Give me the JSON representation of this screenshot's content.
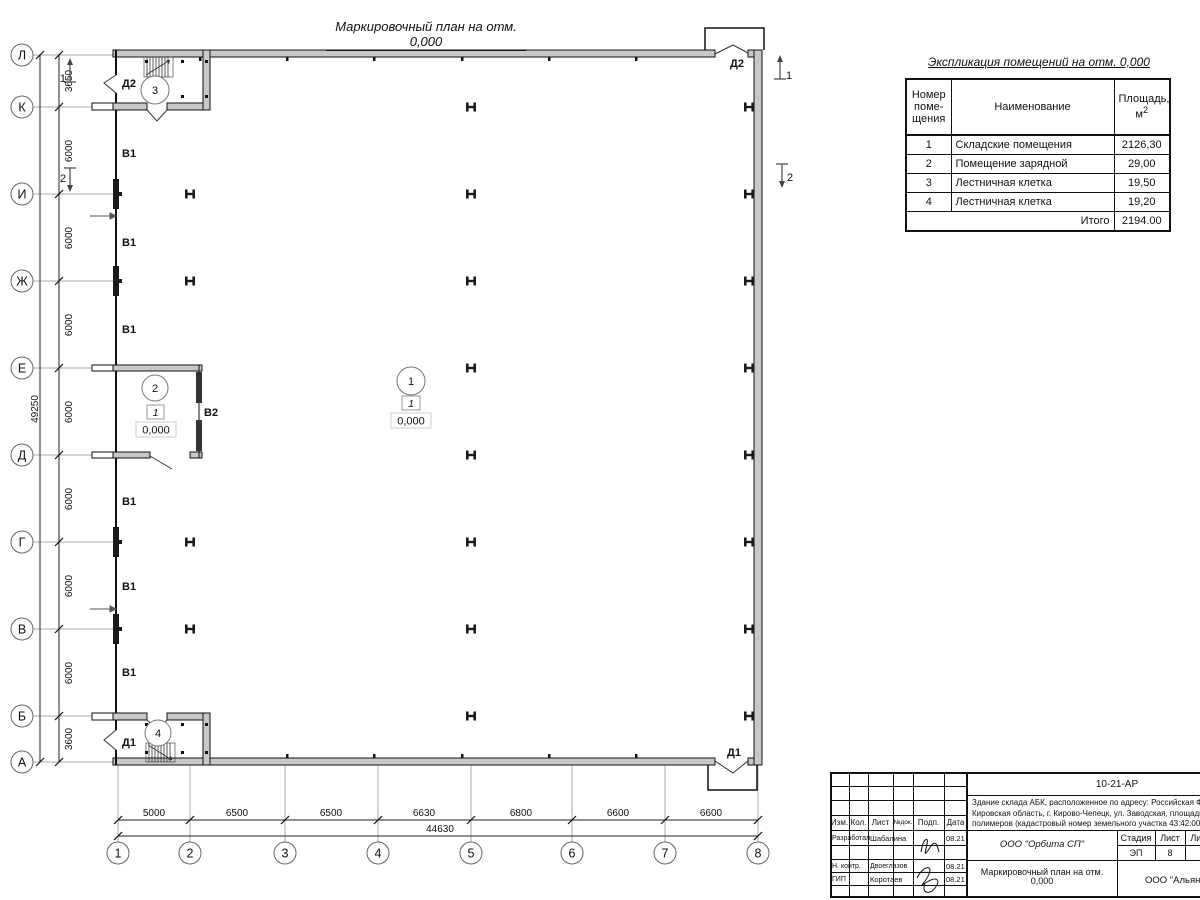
{
  "colors": {
    "line": "#1a1a1a",
    "grid": "#a0a0a0",
    "wall_fill": "#c8c8c8",
    "paper": "#ffffff"
  },
  "drawing_title": "Маркировочный план на отм. 0,000",
  "schedule": {
    "title": "Экспликация помещений на отм. 0,000",
    "col_number": "Номер\nпоме-\nщения",
    "col_name": "Наименование",
    "col_area_1": "Площадь,",
    "col_area_2": "м",
    "col_area_sup": "2",
    "rows": [
      {
        "number": "1",
        "name": "Складские помещения",
        "area": "2126,30"
      },
      {
        "number": "2",
        "name": "Помещение зарядной",
        "area": "29,00"
      },
      {
        "number": "3",
        "name": "Лестничная клетка",
        "area": "19,50"
      },
      {
        "number": "4",
        "name": "Лестничная клетка",
        "area": "19,20"
      }
    ],
    "total_label": "Итого",
    "total_value": "2194.00"
  },
  "plan": {
    "row_axes": [
      "Л",
      "К",
      "И",
      "Ж",
      "Е",
      "Д",
      "Г",
      "В",
      "Б",
      "А"
    ],
    "col_axes": [
      "1",
      "2",
      "3",
      "4",
      "5",
      "6",
      "7",
      "8"
    ],
    "dims_v": [
      "3650",
      "6000",
      "6000",
      "6000",
      "6000",
      "6000",
      "6000",
      "6000",
      "3600"
    ],
    "dims_v_total": "49250",
    "dims_h": [
      "5000",
      "6500",
      "6500",
      "6630",
      "6800",
      "6600",
      "6600"
    ],
    "dims_h_total": "44630",
    "door_d1": "Д1",
    "door_d2": "Д2",
    "gate_v1": "В1",
    "gate_v2": "В2",
    "room1": "1",
    "room2": "2",
    "room3": "3",
    "room4": "4",
    "floor_type": "1",
    "elevation": "0,000",
    "section_1": "1",
    "section_2": "2"
  },
  "titleblock": {
    "doc_number": "10-21-АР",
    "description_lines": [
      "Здание склада АБК, расположенное по адресу: Российская Феде",
      "Кировская область, г. Кирово-Чепецк, ул. Заводская, площадка з",
      "полимеров (кадастровый номер земельного участка 43:42:00000"
    ],
    "cols": [
      "Изм.",
      "Кол.",
      "Лист",
      "№док.",
      "Подп.",
      "Дата"
    ],
    "rows": [
      {
        "role": "Разработал",
        "name": "Шабалина",
        "date": "08.21"
      },
      {
        "role": "Н. контр.",
        "name": "Двоеглазов",
        "date": "08.21"
      },
      {
        "role": "ГИП",
        "name": "Коротаев",
        "date": "08.21"
      }
    ],
    "company": "ООО \"Орбита СП\"",
    "stage_label": "Стадия",
    "sheet_label": "Лист",
    "sheets_label": "Листов",
    "stage": "ЭП",
    "sheet": "8",
    "sheets": "1",
    "sheet_title": "Маркировочный план на отм.\n0,000",
    "contractor": "ООО \"Альянс"
  }
}
